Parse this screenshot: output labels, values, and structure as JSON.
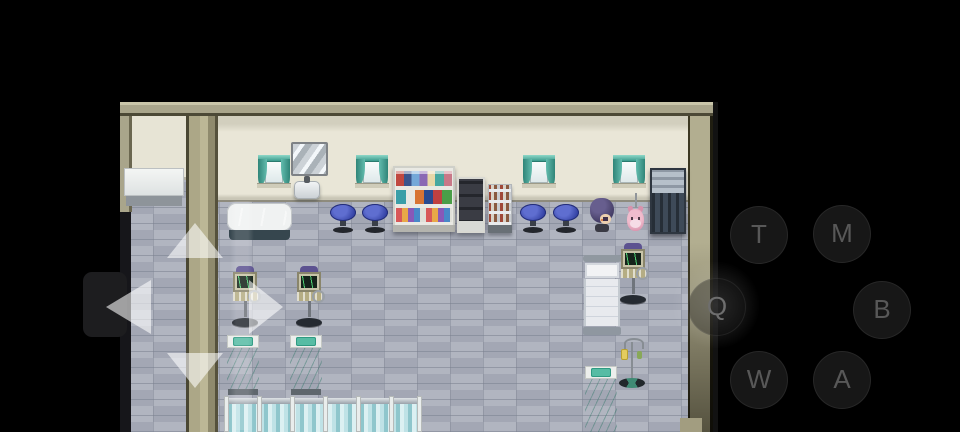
{
  "app": {
    "name": "rpg-emulator-touch-overlay"
  },
  "palette": {
    "background": "#000000",
    "wall_tan": "#a9a58b",
    "wall_cream": "#e9e6d7",
    "floor_gray": "#a8acb8",
    "curtain_teal": "#4aa89a",
    "bed_teal": "#45b092",
    "stool_blue": "#3948a8",
    "button_letter": "#585858"
  },
  "controller": {
    "buttons": [
      {
        "label": "T",
        "x": 759,
        "y": 235,
        "glow": false
      },
      {
        "label": "M",
        "x": 842,
        "y": 234,
        "glow": false
      },
      {
        "label": "Q",
        "x": 717,
        "y": 307,
        "glow": true
      },
      {
        "label": "B",
        "x": 882,
        "y": 310,
        "glow": false
      },
      {
        "label": "W",
        "x": 759,
        "y": 380,
        "glow": false
      },
      {
        "label": "A",
        "x": 842,
        "y": 380,
        "glow": false
      }
    ],
    "dpad": {
      "cx": 195,
      "cy": 307,
      "directions": [
        "up",
        "down",
        "left",
        "right"
      ]
    }
  },
  "scene": {
    "setting": "top-down RPG hospital interior with tiled floor",
    "objects": [
      {
        "type": "mirror",
        "x": 291,
        "y": 142
      },
      {
        "type": "window",
        "x": 258,
        "y": 155
      },
      {
        "type": "window",
        "x": 356,
        "y": 155
      },
      {
        "type": "window",
        "x": 523,
        "y": 155
      },
      {
        "type": "window",
        "x": 613,
        "y": 155
      },
      {
        "type": "sink",
        "x": 294,
        "y": 176
      },
      {
        "type": "bigshelf",
        "x": 393,
        "y": 166
      },
      {
        "type": "cabinet",
        "x": 457,
        "y": 177
      },
      {
        "type": "smallshelf",
        "x": 488,
        "y": 184
      },
      {
        "type": "locker",
        "x": 650,
        "y": 168
      },
      {
        "type": "table",
        "x": 124,
        "y": 168
      },
      {
        "type": "tub",
        "x": 227,
        "y": 203
      },
      {
        "type": "stool",
        "x": 330,
        "y": 204
      },
      {
        "type": "stool",
        "x": 362,
        "y": 204
      },
      {
        "type": "stool",
        "x": 520,
        "y": 204
      },
      {
        "type": "stool",
        "x": 553,
        "y": 204
      },
      {
        "type": "character",
        "x": 590,
        "y": 198
      },
      {
        "type": "creature",
        "x": 627,
        "y": 193
      },
      {
        "type": "ekg",
        "x": 232,
        "y": 266
      },
      {
        "type": "ekg",
        "x": 296,
        "y": 266
      },
      {
        "type": "ekg",
        "x": 620,
        "y": 243
      },
      {
        "type": "bedwhite",
        "x": 583,
        "y": 255
      },
      {
        "type": "bedgreen",
        "x": 227,
        "y": 335
      },
      {
        "type": "bedgreen",
        "x": 290,
        "y": 335
      },
      {
        "type": "ivstand",
        "x": 618,
        "y": 338
      },
      {
        "type": "bedgreen",
        "x": 585,
        "y": 366,
        "variant": "cut"
      },
      {
        "type": "stripedrow",
        "x": 224,
        "y": 398
      },
      {
        "type": "lightshaft",
        "x": 230,
        "y": 201
      }
    ]
  }
}
